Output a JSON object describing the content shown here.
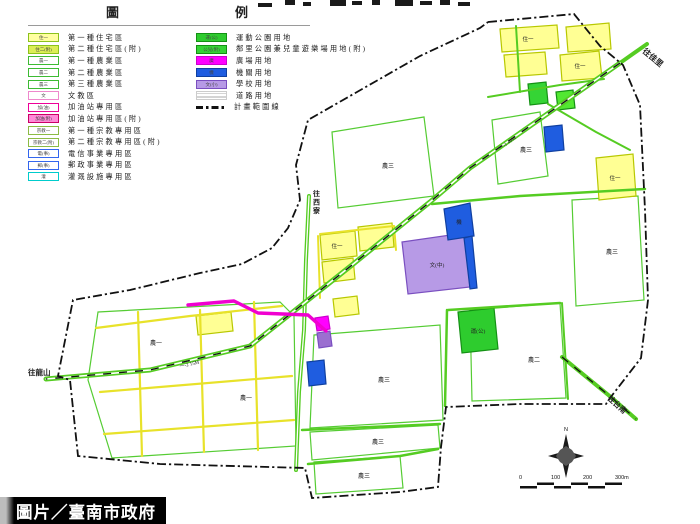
{
  "caption": {
    "text": "圖片／臺南市政府"
  },
  "legend": {
    "title_left": "圖",
    "title_right": "例",
    "left_items": [
      {
        "swatch_label": "住一",
        "fill": "#ffffa0",
        "border": "#8cc21c",
        "text": "第一種住宅區"
      },
      {
        "swatch_label": "住二(附)",
        "fill": "#dcee55",
        "border": "#8cc21c",
        "text": "第二種住宅區(附)"
      },
      {
        "swatch_label": "農一",
        "fill": "#ffffff",
        "border": "#3dbb33",
        "text": "第一種農業區"
      },
      {
        "swatch_label": "農二",
        "fill": "#ffffff",
        "border": "#3dbb33",
        "text": "第二種農業區"
      },
      {
        "swatch_label": "農三",
        "fill": "#ffffff",
        "border": "#3dbb33",
        "text": "第三種農業區"
      },
      {
        "swatch_label": "文",
        "fill": "#ffffff",
        "border": "#ee88cc",
        "text": "文教區"
      },
      {
        "swatch_label": "加(油)",
        "fill": "#ffffff",
        "border": "#ee0099",
        "text": "加油站專用區"
      },
      {
        "swatch_label": "加油(附)",
        "fill": "#ff8ad8",
        "border": "#cc0066",
        "text": "加油站專用區(附)"
      },
      {
        "swatch_label": "宗教一",
        "fill": "#ffffff",
        "border": "#8cbb44",
        "text": "第一種宗教專用區"
      },
      {
        "swatch_label": "宗教二(附)",
        "fill": "#ffffff",
        "border": "#8cbb44",
        "text": "第二種宗教專用區(附)"
      },
      {
        "swatch_label": "電(事)",
        "fill": "#ffffff",
        "border": "#3366ee",
        "text": "電信事業專用區"
      },
      {
        "swatch_label": "郵(事)",
        "fill": "#ffffff",
        "border": "#3366ee",
        "text": "郵政事業專用區"
      },
      {
        "swatch_label": "灌",
        "fill": "#ffffff",
        "border": "#00cccc",
        "text": "灌溉設施專用區"
      }
    ],
    "right_items": [
      {
        "swatch_label": "運(公)",
        "fill": "#2ecc2e",
        "border": "#149114",
        "text": "運動公園用地"
      },
      {
        "swatch_label": "公兒(附)",
        "fill": "#35d435",
        "border": "#149114",
        "text": "鄰里公園兼兒童遊樂場用地(附)"
      },
      {
        "swatch_label": "廣",
        "fill": "#ff00ff",
        "border": "#cc00cc",
        "text": "廣場用地"
      },
      {
        "swatch_label": "機",
        "fill": "#1f5de0",
        "border": "#1040a0",
        "text": "機關用地"
      },
      {
        "swatch_label": "文(小)",
        "fill": "#b79ae6",
        "border": "#7a4fc0",
        "text": "學校用地"
      },
      {
        "type": "road",
        "text": "道路用地"
      },
      {
        "type": "boundary",
        "text": "計畫範圍線"
      }
    ]
  },
  "map": {
    "boundary": {
      "points": "488,22 574,14 600,46 623,65 640,105 645,210 648,300 641,358 610,398 606,404 520,404 446,407 441,447 438,487 400,492 312,498 305,468 160,464 78,456 70,380 58,376 73,300 130,290 200,273 242,264 272,248 288,228 300,200 296,165 308,120 420,56 480,28 488,22",
      "color": "#111111"
    },
    "zones": [
      {
        "points": "98,312 280,302 294,316 296,446 112,458 88,380",
        "fill": "#ffffff",
        "stroke": "#55cc33"
      },
      {
        "points": "314,335 440,325 443,420 310,428",
        "fill": "#ffffff",
        "stroke": "#55cc33"
      },
      {
        "points": "310,432 438,425 440,448 312,460",
        "fill": "#ffffff",
        "stroke": "#55cc33"
      },
      {
        "points": "314,462 400,456 403,488 316,494",
        "fill": "#ffffff",
        "stroke": "#55cc33"
      },
      {
        "points": "470,310 560,303 566,398 472,401",
        "fill": "#ffffff",
        "stroke": "#55cc33"
      },
      {
        "points": "572,200 638,196 644,300 576,306",
        "fill": "#ffffff",
        "stroke": "#55cc33"
      },
      {
        "points": "332,132 424,117 434,196 338,208",
        "fill": "#ffffff",
        "stroke": "#55cc33"
      },
      {
        "points": "492,120 540,112 548,176 498,184",
        "fill": "#ffffff",
        "stroke": "#55cc33"
      },
      {
        "points": "500,29 557,25 559,48 502,52",
        "fill": "#ffff94",
        "stroke": "#b8c800",
        "label": "住一",
        "lx": 528,
        "ly": 41
      },
      {
        "points": "504,55 545,52 547,74 506,77",
        "fill": "#ffff94",
        "stroke": "#b8c800"
      },
      {
        "points": "560,55 599,51 602,78 562,81",
        "fill": "#ffff94",
        "stroke": "#b8c800",
        "label": "住一",
        "lx": 580,
        "ly": 68
      },
      {
        "points": "566,27 609,23 611,49 568,52",
        "fill": "#ffff94",
        "stroke": "#b8c800"
      },
      {
        "points": "320,235 355,231 357,256 322,260",
        "fill": "#ffff94",
        "stroke": "#b8c800",
        "label": "住一",
        "lx": 337,
        "ly": 248
      },
      {
        "points": "358,227 392,223 394,247 360,251",
        "fill": "#ffff94",
        "stroke": "#b8c800"
      },
      {
        "points": "322,262 353,258 355,279 324,283",
        "fill": "#ffff94",
        "stroke": "#b8c800"
      },
      {
        "points": "596,158 633,154 636,196 599,200",
        "fill": "#ffff94",
        "stroke": "#b8c800",
        "label": "住一",
        "lx": 615,
        "ly": 180
      },
      {
        "points": "196,316 231,312 233,331 198,335",
        "fill": "#ffff94",
        "stroke": "#b8c800"
      },
      {
        "points": "333,299 357,296 359,314 335,317",
        "fill": "#ffff94",
        "stroke": "#b8c800"
      },
      {
        "points": "402,242 464,233 470,287 408,294",
        "fill": "#b79ae6",
        "stroke": "#7a4fc0",
        "label": "文(中)",
        "lx": 437,
        "ly": 267
      },
      {
        "points": "444,209 470,203 474,236 448,240",
        "fill": "#1f5de0",
        "stroke": "#1040a0",
        "label": "機",
        "lx": 459,
        "ly": 224
      },
      {
        "points": "464,238 472,236 477,288 470,289",
        "fill": "#1f5de0",
        "stroke": "#1040a0"
      },
      {
        "points": "544,127 562,125 564,150 546,152",
        "fill": "#1f5de0",
        "stroke": "#1040a0"
      },
      {
        "points": "307,362 324,360 326,384 309,386",
        "fill": "#1f5de0",
        "stroke": "#1040a0"
      },
      {
        "points": "458,312 494,308 498,349 462,353",
        "fill": "#2ecc2e",
        "stroke": "#149114",
        "label": "運(公)",
        "lx": 478,
        "ly": 333
      },
      {
        "points": "528,84 546,82 548,103 530,105",
        "fill": "#35d435",
        "stroke": "#149114"
      },
      {
        "points": "556,92 573,90 575,108 558,110",
        "fill": "#52e832",
        "stroke": "#149114"
      },
      {
        "points": "315,318 328,316 330,329 317,331",
        "fill": "#ff00ff",
        "stroke": "#cc00cc"
      },
      {
        "points": "317,333 330,331 332,346 319,348",
        "fill": "#9b6fd0",
        "stroke": "#7a4fc0"
      }
    ],
    "roads": [
      {
        "points": "96,328 190,316 282,306",
        "color": "#e8e22a",
        "w": 2.2
      },
      {
        "points": "100,392 292,376",
        "color": "#e8e22a",
        "w": 2.2
      },
      {
        "points": "104,434 294,420",
        "color": "#e8e22a",
        "w": 2.2
      },
      {
        "points": "138,312 142,456",
        "color": "#e8e22a",
        "w": 2.2
      },
      {
        "points": "200,310 204,452",
        "color": "#e8e22a",
        "w": 2.2
      },
      {
        "points": "254,302 258,450",
        "color": "#e8e22a",
        "w": 2.2
      },
      {
        "points": "318,236 320,298",
        "color": "#e8e22a",
        "w": 2
      },
      {
        "points": "320,234 394,226",
        "color": "#e8e22a",
        "w": 2
      },
      {
        "points": "394,226 396,250",
        "color": "#e8e22a",
        "w": 2
      },
      {
        "points": "432,204 520,196 645,189",
        "color": "#55cc22",
        "w": 2.5
      },
      {
        "points": "448,310 560,303",
        "color": "#55cc22",
        "w": 2.5
      },
      {
        "points": "447,310 445,406",
        "color": "#55cc22",
        "w": 2.5
      },
      {
        "points": "562,303 568,399",
        "color": "#55cc22",
        "w": 2
      },
      {
        "points": "302,430 440,424",
        "color": "#55cc22",
        "w": 2.5
      },
      {
        "points": "308,464 400,456 438,449",
        "color": "#55cc22",
        "w": 2.5
      },
      {
        "points": "516,26 520,92",
        "color": "#55cc22",
        "w": 2
      },
      {
        "points": "488,97 560,85 604,79",
        "color": "#55cc22",
        "w": 2
      },
      {
        "points": "548,104 596,132 630,150",
        "color": "#55cc22",
        "w": 2
      },
      {
        "points": "620,63 647,44",
        "color": "#55cc22",
        "w": 4
      },
      {
        "points": "309,196 306,260 304,330 299,392 296,470",
        "color": "#55cc22",
        "w": 4,
        "core": true
      },
      {
        "points": "562,357 612,398 636,419",
        "color": "#55cc22",
        "w": 4,
        "dash": true
      },
      {
        "points": "620,63 560,105 470,168 430,202 352,265 308,300 250,346 150,370 46,379",
        "color": "#55cc22",
        "w": 5,
        "core": true,
        "dash": true
      },
      {
        "points": "188,305 234,301 258,313 308,315 326,331",
        "color": "#f000d0",
        "w": 3.4
      }
    ],
    "labels": [
      {
        "t": "往佳里",
        "x": 642,
        "y": 52,
        "rot": 40,
        "size": 8,
        "bold": true
      },
      {
        "t": "往西寮",
        "x": 313,
        "y": 196,
        "vertical": true,
        "size": 7,
        "bold": true
      },
      {
        "t": "往龍山",
        "x": 28,
        "y": 375,
        "size": 7.5,
        "bold": true
      },
      {
        "t": "往台南",
        "x": 607,
        "y": 399,
        "rot": 42,
        "size": 7.5,
        "bold": true
      },
      {
        "t": "農一",
        "x": 150,
        "y": 345,
        "size": 6
      },
      {
        "t": "農一",
        "x": 240,
        "y": 400,
        "size": 6
      },
      {
        "t": "農三",
        "x": 378,
        "y": 382,
        "size": 6
      },
      {
        "t": "農三",
        "x": 372,
        "y": 444,
        "size": 6
      },
      {
        "t": "農三",
        "x": 358,
        "y": 478,
        "size": 6
      },
      {
        "t": "農二",
        "x": 528,
        "y": 362,
        "size": 6
      },
      {
        "t": "農三",
        "x": 606,
        "y": 254,
        "size": 6
      },
      {
        "t": "農三",
        "x": 382,
        "y": 168,
        "size": 6
      },
      {
        "t": "農三",
        "x": 520,
        "y": 152,
        "size": 6
      },
      {
        "t": "一-1 40M",
        "x": 500,
        "y": 150,
        "rot": -35,
        "size": 5
      },
      {
        "t": "一-2 15M",
        "x": 180,
        "y": 368,
        "rot": -13,
        "size": 5
      }
    ]
  },
  "scalebar": {
    "labels": [
      "0",
      "100",
      "200",
      "300m"
    ]
  },
  "compass": {
    "label": "N"
  }
}
